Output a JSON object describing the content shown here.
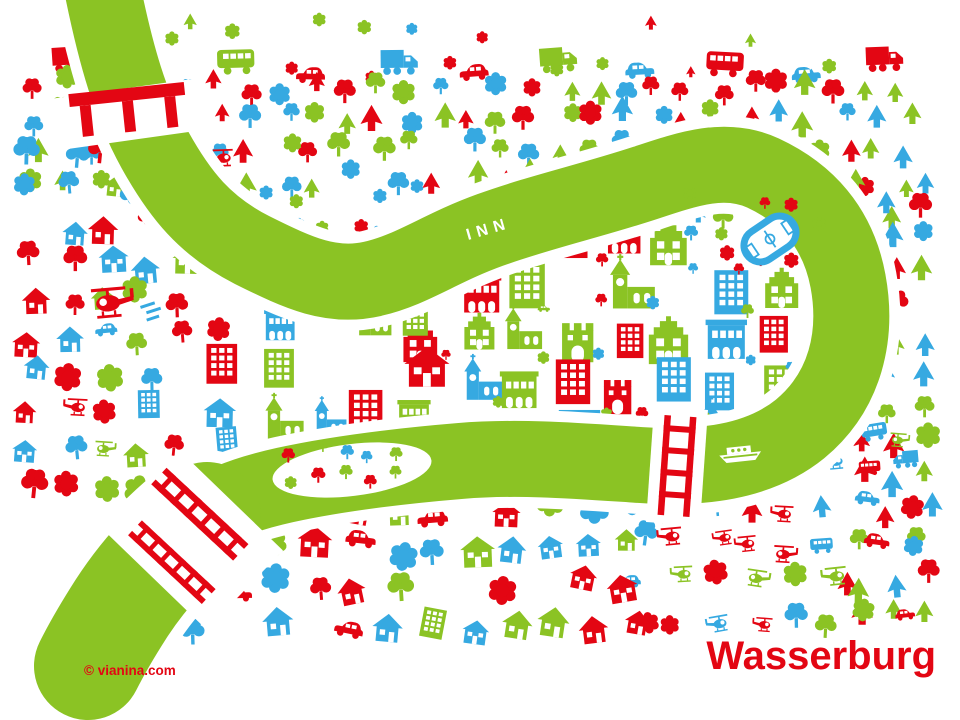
{
  "map": {
    "title": "Wasserburg",
    "river_label": "INN",
    "credit": "© vianina.com",
    "palette": {
      "red": "#E30613",
      "blue": "#36A9E1",
      "green": "#8BC324",
      "white": "#FFFFFF"
    },
    "icon_types": [
      "flower",
      "tree",
      "fir-tree",
      "house",
      "two-story-house",
      "apartment-block",
      "gabled-townhouse",
      "arcade-building",
      "church",
      "gate-tower",
      "cemetery-cross",
      "car",
      "truck",
      "bus",
      "helicopter",
      "boat",
      "stadium",
      "viaduct-bridge",
      "railway-bridge",
      "town-bridge"
    ]
  }
}
